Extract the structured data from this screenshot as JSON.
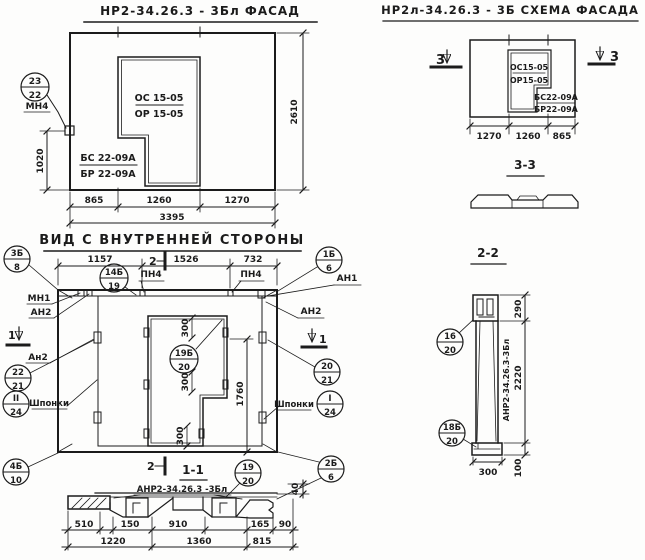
{
  "facade": {
    "title": "НР2-34.26.3 - 3Бл ФАСАД",
    "opening_mark_line1": "ОС 15-05",
    "opening_mark_line2": "ОР 15-05",
    "panel_mark_line1": "БС 22-09А",
    "panel_mark_line2": "БР 22-09А",
    "callout_top": "23",
    "callout_bottom": "22",
    "callout_label": "МН4",
    "dim_height_part": "1020",
    "dim_height_total": "2610",
    "dim_w1": "865",
    "dim_w2": "1260",
    "dim_w3": "1270",
    "dim_w_total": "3395"
  },
  "schema": {
    "title": "НР2л-34.26.3 - 3Б СХЕМА ФАСАДА",
    "opening_mark_line1": "ОС15-05",
    "opening_mark_line2": "ОР15-05",
    "panel_mark_line1": "БС22-09А",
    "panel_mark_line2": "БР22-09А",
    "section_mark": "3",
    "dim_w1": "1270",
    "dim_w2": "1260",
    "dim_w3": "865"
  },
  "section33": {
    "title": "3-3"
  },
  "inner": {
    "title": "ВИД С ВНУТРЕННЕЙ СТОРОНЫ",
    "dim_t1": "1157",
    "dim_t2": "1526",
    "dim_t3": "732",
    "marker2": "2",
    "marker1": "1",
    "pn4": "ПН4",
    "mn1": "МН1",
    "an1": "АН1",
    "an2": "АН2",
    "an2_lower": "Ан2",
    "shponki": "Шпонки",
    "dim_300": "300",
    "dim_1760": "1760",
    "callouts": {
      "c14b19": {
        "top": "14Б",
        "bottom": "19"
      },
      "c1b6": {
        "top": "1Б",
        "bottom": "6"
      },
      "c3b8": {
        "top": "3Б",
        "bottom": "8"
      },
      "c22_21": {
        "top": "22",
        "bottom": "21"
      },
      "cII24": {
        "top": "II",
        "bottom": "24"
      },
      "c4b10": {
        "top": "4Б",
        "bottom": "10"
      },
      "c20_21": {
        "top": "20",
        "bottom": "21"
      },
      "cI24": {
        "top": "I",
        "bottom": "24"
      },
      "c2b6": {
        "top": "2Б",
        "bottom": "6"
      },
      "c19b20": {
        "top": "19Б",
        "bottom": "20"
      }
    }
  },
  "section11": {
    "title": "1-1",
    "label": "АНР2-34.26.3 -3Бл",
    "dim_40": "40",
    "callout_19_20": {
      "top": "19",
      "bottom": "20"
    },
    "dims_row1": [
      "510",
      "150",
      "910",
      "165",
      "90"
    ],
    "dims_row2": [
      "1220",
      "1360",
      "815"
    ]
  },
  "section22": {
    "title": "2-2",
    "dim_290": "290",
    "dim_2220": "2220",
    "dim_100": "100",
    "dim_300": "300",
    "side_label": "АНР2-34.26.3-3Бл",
    "callout_16_20": {
      "top": "16",
      "bottom": "20"
    },
    "callout_18b20": {
      "top": "18Б",
      "bottom": "20"
    }
  }
}
